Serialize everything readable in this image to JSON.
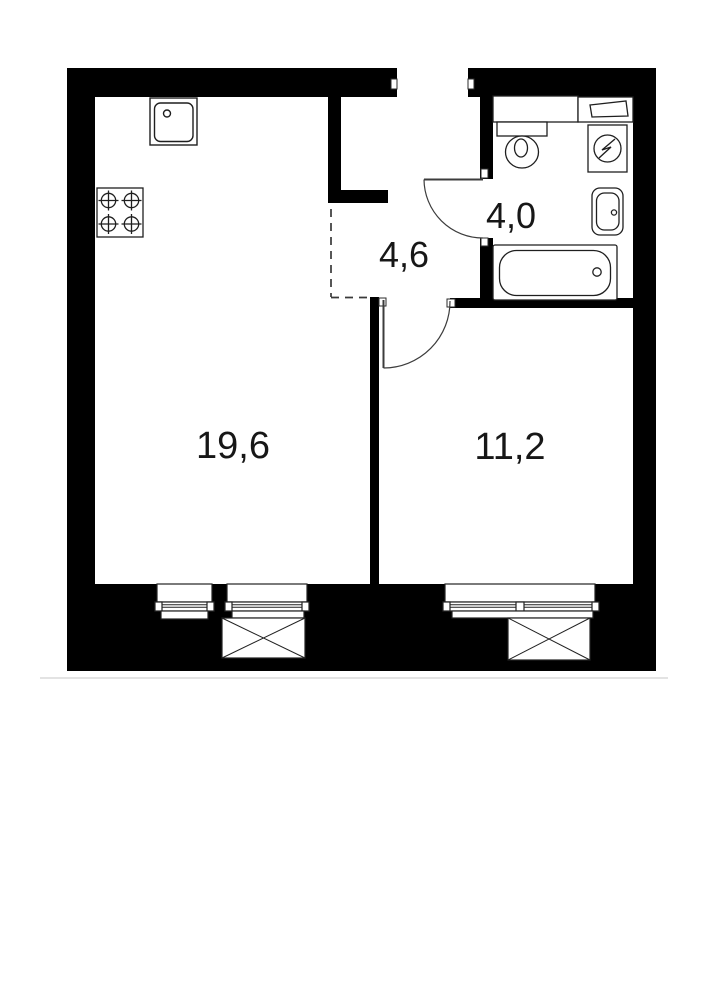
{
  "page": {
    "background_color": "#ffffff",
    "content_type": "apartment floor plan drawing"
  },
  "floor_plan": {
    "wall_color": "#000000",
    "line_color": "#222222",
    "label_color": "#171717",
    "rooms": [
      {
        "id": "living-kitchen",
        "area_label": "19,6"
      },
      {
        "id": "bedroom",
        "area_label": "11,2"
      },
      {
        "id": "hallway",
        "area_label": "4,6"
      },
      {
        "id": "bathroom",
        "area_label": "4,0"
      }
    ],
    "fixtures": [
      "kitchen-sink-icon",
      "stove-4-burner-icon",
      "bathroom-vanity-icon",
      "toilet-icon",
      "boiler-shelf-icon",
      "washing-machine-icon",
      "bathroom-sink-icon",
      "bathtub-icon",
      "window-icon",
      "shaft-box-icon",
      "door-swing-icon",
      "dashed-zone-boundary"
    ]
  }
}
